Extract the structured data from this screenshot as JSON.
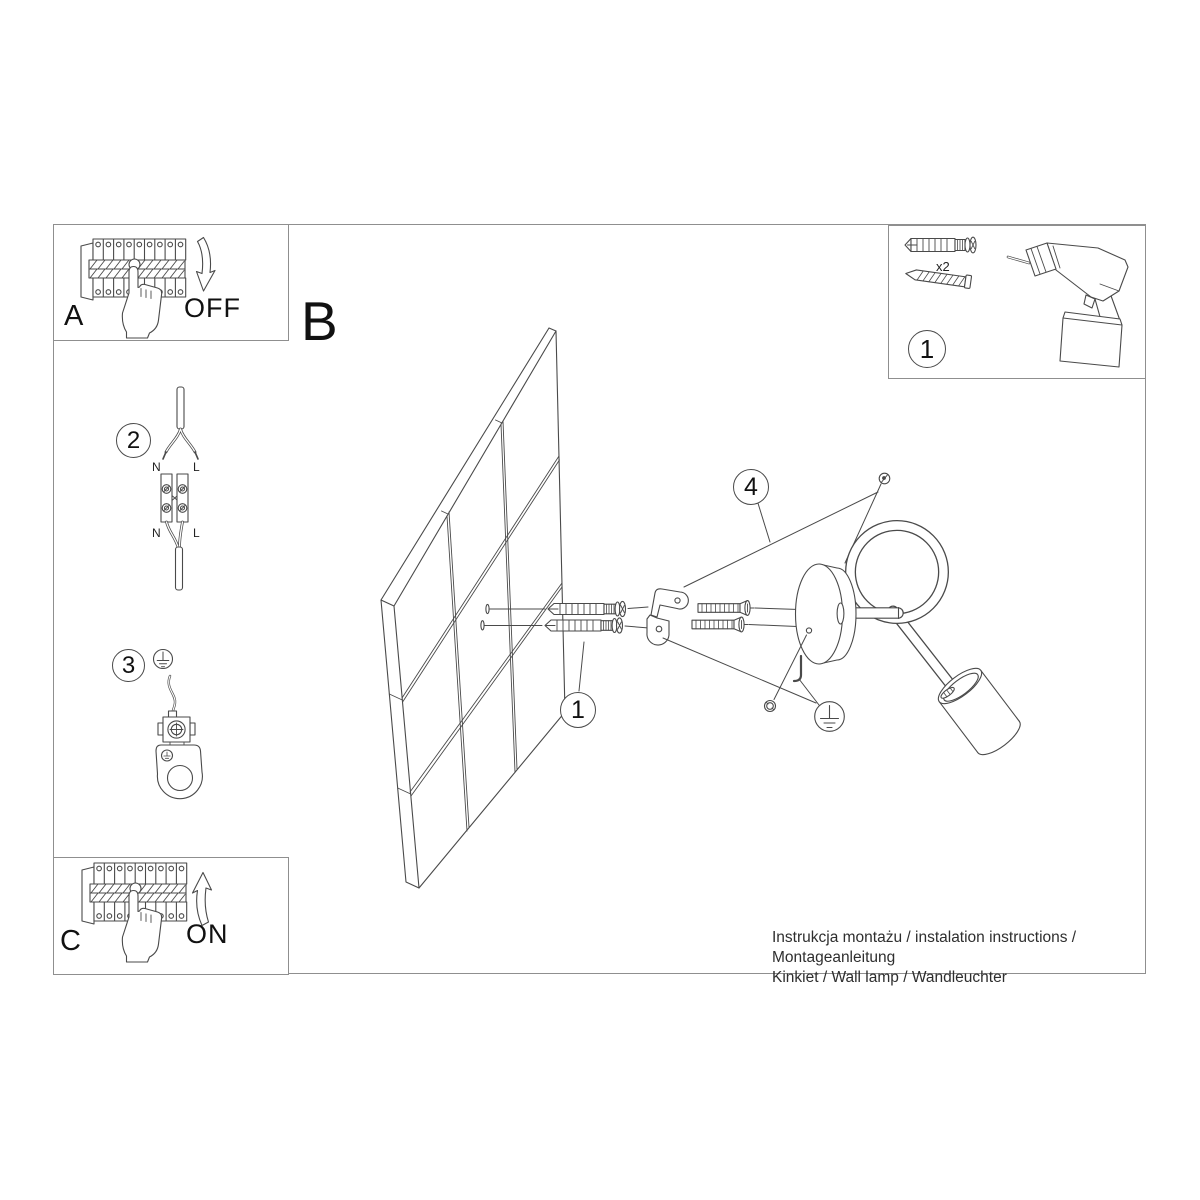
{
  "panel_a": {
    "label": "A",
    "state": "OFF"
  },
  "panel_b": {
    "label": "B"
  },
  "panel_c": {
    "label": "C",
    "state": "ON"
  },
  "kit": {
    "step": "1",
    "anchor_qty": "x2"
  },
  "wiring": {
    "step": "2",
    "top_n": "N",
    "top_l": "L",
    "bottom_n": "N",
    "bottom_l": "L"
  },
  "grounding": {
    "step": "3"
  },
  "assembly": {
    "plug_callout": "1",
    "bracket_callout": "4"
  },
  "footer": {
    "line1": "Instrukcja montażu / instalation instructions / Montageanleitung",
    "line2": "Kinkiet / Wall lamp / Wandleuchter"
  }
}
